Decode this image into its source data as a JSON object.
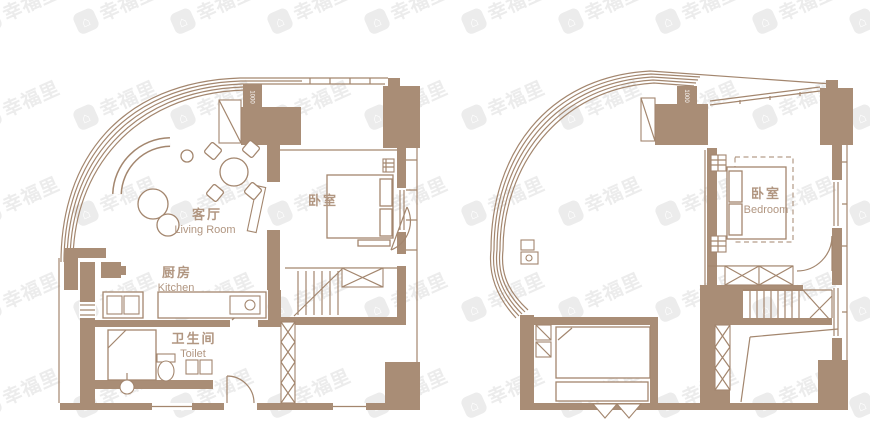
{
  "palette": {
    "wall": "#a98d76",
    "line": "#a3866e",
    "label": "#b19681",
    "watermark": "#ececec",
    "background": "#ffffff"
  },
  "watermark": {
    "text": "幸福里",
    "icon": "house-icon"
  },
  "plans": {
    "lower": {
      "living_zh": "客厅",
      "living_en": "Living Room",
      "kitchen_zh": "厨房",
      "kitchen_en": "Kitchen",
      "toilet_zh": "卫生间",
      "toilet_en": "Toilet",
      "bedroom_zh": "卧室",
      "dim": "1000"
    },
    "upper": {
      "bedroom_zh": "卧室",
      "bedroom_en": "Bedroom",
      "dim": "1000"
    }
  }
}
